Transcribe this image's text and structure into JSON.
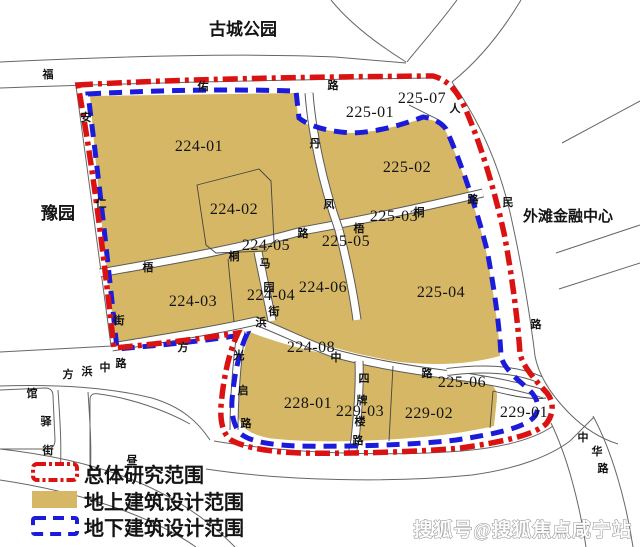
{
  "legend": {
    "items": [
      {
        "label": "总体研究范围",
        "swatch": "red-dashdot-outline"
      },
      {
        "label": "地上建筑设计范围",
        "swatch": "tan-fill"
      },
      {
        "label": "地下建筑设计范围",
        "swatch": "blue-dash-outline"
      }
    ]
  },
  "watermark": "搜狐号@搜狐焦点咸宁站",
  "colors": {
    "parcel_fill": "#d5b765",
    "study_boundary_red": "#da1212",
    "underground_boundary_blue": "#1b1bdb",
    "road_line": "#666666"
  },
  "places": [
    {
      "name": "古城公园",
      "x": 243,
      "y": 35,
      "size": 17
    },
    {
      "name": "豫园",
      "x": 58,
      "y": 219,
      "size": 17
    },
    {
      "name": "外滩金融中心",
      "x": 568,
      "y": 221,
      "size": 15
    }
  ],
  "parcels": [
    {
      "id": "224-01",
      "x": 199,
      "y": 151
    },
    {
      "id": "224-02",
      "x": 234,
      "y": 214
    },
    {
      "id": "224-05",
      "x": 266,
      "y": 250
    },
    {
      "id": "224-03",
      "x": 193,
      "y": 306
    },
    {
      "id": "224-04",
      "x": 271,
      "y": 300
    },
    {
      "id": "224-06",
      "x": 323,
      "y": 292
    },
    {
      "id": "224-08",
      "x": 311,
      "y": 352
    },
    {
      "id": "225-01",
      "x": 370,
      "y": 117
    },
    {
      "id": "225-07",
      "x": 422,
      "y": 103
    },
    {
      "id": "225-02",
      "x": 407,
      "y": 172
    },
    {
      "id": "225-03",
      "x": 394,
      "y": 221
    },
    {
      "id": "225-05",
      "x": 346,
      "y": 246
    },
    {
      "id": "225-04",
      "x": 441,
      "y": 297
    },
    {
      "id": "225-06",
      "x": 462,
      "y": 387
    },
    {
      "id": "228-01",
      "x": 308,
      "y": 408
    },
    {
      "id": "229-03",
      "x": 360,
      "y": 416
    },
    {
      "id": "229-02",
      "x": 429,
      "y": 418
    },
    {
      "id": "229-01",
      "x": 524,
      "y": 417
    }
  ],
  "streets": [
    {
      "name": "福佑路",
      "chars": [
        {
          "t": "福",
          "x": 48,
          "y": 78
        },
        {
          "t": "佑",
          "x": 203,
          "y": 90
        },
        {
          "t": "路",
          "x": 333,
          "y": 89
        }
      ]
    },
    {
      "name": "人民路",
      "chars": [
        {
          "t": "人",
          "x": 455,
          "y": 112
        },
        {
          "t": "民",
          "x": 508,
          "y": 206
        },
        {
          "t": "路",
          "x": 536,
          "y": 328
        }
      ]
    },
    {
      "name": "中华路",
      "chars": [
        {
          "t": "中",
          "x": 583,
          "y": 441
        },
        {
          "t": "华",
          "x": 597,
          "y": 455
        },
        {
          "t": "路",
          "x": 603,
          "y": 472
        }
      ]
    },
    {
      "name": "丹凤路",
      "chars": [
        {
          "t": "丹",
          "x": 315,
          "y": 147
        },
        {
          "t": "凤",
          "x": 329,
          "y": 208
        }
      ]
    },
    {
      "name": "梧桐路",
      "chars": [
        {
          "t": "梧",
          "x": 148,
          "y": 271
        },
        {
          "t": "桐",
          "x": 234,
          "y": 260
        },
        {
          "t": "路",
          "x": 303,
          "y": 237
        },
        {
          "t": "梧",
          "x": 359,
          "y": 232
        },
        {
          "t": "桐",
          "x": 419,
          "y": 216
        },
        {
          "t": "路",
          "x": 473,
          "y": 203
        }
      ]
    },
    {
      "name": "马园街",
      "chars": [
        {
          "t": "马",
          "x": 265,
          "y": 267
        },
        {
          "t": "园",
          "x": 269,
          "y": 291
        },
        {
          "t": "街",
          "x": 274,
          "y": 315
        }
      ]
    },
    {
      "name": "安仁街",
      "chars": [
        {
          "t": "安",
          "x": 86,
          "y": 121
        },
        {
          "t": "仁",
          "x": 101,
          "y": 207
        },
        {
          "t": "街",
          "x": 119,
          "y": 324
        }
      ]
    },
    {
      "name": "方浜中路",
      "chars": [
        {
          "t": "方",
          "x": 68,
          "y": 378
        },
        {
          "t": "浜",
          "x": 87,
          "y": 375
        },
        {
          "t": "中",
          "x": 105,
          "y": 371
        },
        {
          "t": "路",
          "x": 121,
          "y": 367
        },
        {
          "t": "方",
          "x": 183,
          "y": 351
        },
        {
          "t": "浜",
          "x": 261,
          "y": 326
        },
        {
          "t": "中",
          "x": 336,
          "y": 361
        },
        {
          "t": "路",
          "x": 427,
          "y": 377
        }
      ]
    },
    {
      "name": "四牌楼路",
      "chars": [
        {
          "t": "四",
          "x": 364,
          "y": 382
        },
        {
          "t": "牌",
          "x": 362,
          "y": 404
        },
        {
          "t": "楼",
          "x": 360,
          "y": 425
        },
        {
          "t": "路",
          "x": 358,
          "y": 444
        }
      ]
    },
    {
      "name": "光启路",
      "chars": [
        {
          "t": "光",
          "x": 239,
          "y": 359
        },
        {
          "t": "启",
          "x": 243,
          "y": 394
        },
        {
          "t": "路",
          "x": 246,
          "y": 427
        }
      ]
    },
    {
      "name": "馆驿街",
      "chars": [
        {
          "t": "馆",
          "x": 32,
          "y": 397
        },
        {
          "t": "驿",
          "x": 46,
          "y": 425
        },
        {
          "t": "街",
          "x": 48,
          "y": 454
        }
      ]
    },
    {
      "name": "昼锦路",
      "chars": [
        {
          "t": "昼",
          "x": 132,
          "y": 464
        }
      ]
    }
  ]
}
